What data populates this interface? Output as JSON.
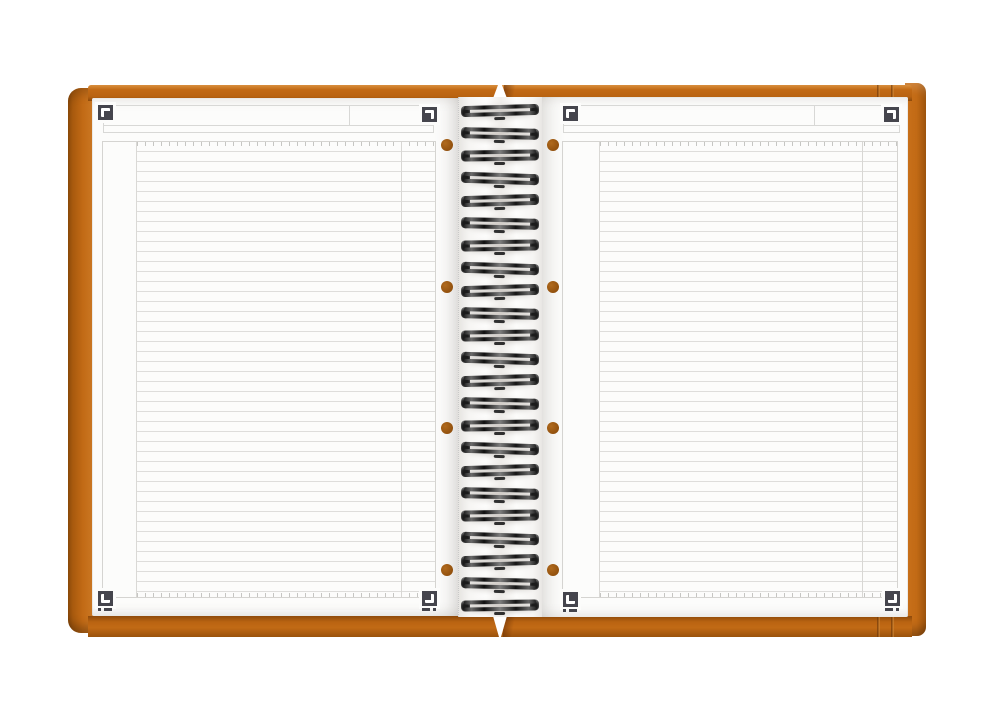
{
  "scene": {
    "subject": "Open twin-wire spiral notebook with orange covers and blank ruled white pages",
    "visible_text": ""
  },
  "colors": {
    "background": "#ffffff",
    "cover_orange": "#c26a15",
    "cover_orange_dark": "#8e4a0a",
    "cover_orange_light": "#d98f3e",
    "paper": "#fcfcfb",
    "rule_line": "#dedddb",
    "frame_line": "#d8d8d6",
    "corner_mark": "#45454d",
    "wire": "#1b1b1b",
    "hole": "#8f4e0c"
  },
  "binding": {
    "loop_count": 23,
    "first_loop_top": 104,
    "loop_pitch": 22.5,
    "wire_style": "black twin-loop wire"
  },
  "left_page": {
    "hole_count": 4,
    "hole_x": 441,
    "holes_y": [
      139,
      281,
      422,
      564
    ],
    "corner_marks": [
      "top-left",
      "top-right",
      "bottom-left",
      "bottom-right"
    ],
    "ruling": "horizontal lines with left margin column and right column rule"
  },
  "right_page": {
    "hole_count": 4,
    "hole_x": 547,
    "holes_y": [
      139,
      281,
      422,
      564
    ],
    "corner_marks": [
      "top-left",
      "top-right",
      "bottom-left",
      "bottom-right"
    ],
    "ruling": "horizontal lines with left margin column and right column rule"
  }
}
